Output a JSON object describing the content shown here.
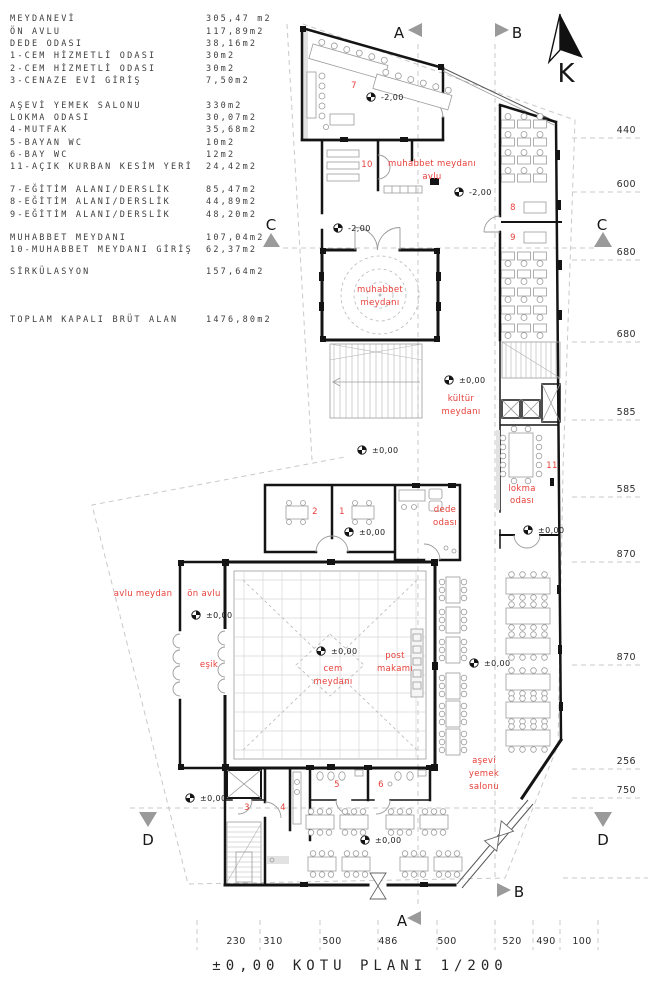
{
  "legend": {
    "rows": [
      {
        "label": "MEYDANEVİ",
        "value": "305,47 m2"
      },
      {
        "label": "ÖN AVLU",
        "value": "117,89m2"
      },
      {
        "label": "DEDE ODASI",
        "value": "38,16m2"
      },
      {
        "label": "1-CEM HİZMETLİ ODASI",
        "value": "30m2"
      },
      {
        "label": "2-CEM HİZMETLİ ODASI",
        "value": "30m2"
      },
      {
        "label": "3-CENAZE EVİ GİRİŞ",
        "value": "7,50m2"
      },
      {
        "label": "AŞEVİ YEMEK SALONU",
        "value": "330m2"
      },
      {
        "label": "LOKMA ODASI",
        "value": "30,07m2"
      },
      {
        "label": "4-MUTFAK",
        "value": "35,68m2"
      },
      {
        "label": "5-BAYAN WC",
        "value": "10m2"
      },
      {
        "label": "6-BAY WC",
        "value": "12m2"
      },
      {
        "label": "11-AÇIK KURBAN KESİM YERİ",
        "value": "24,42m2"
      },
      {
        "label": "7-EĞİTİM ALANI/DERSLİK",
        "value": "85,47m2"
      },
      {
        "label": "8-EĞİTİM ALANI/DERSLİK",
        "value": "44,89m2"
      },
      {
        "label": "9-EĞİTİM ALANI/DERSLİK",
        "value": "48,20m2"
      },
      {
        "label": "MUHABBET MEYDANI",
        "value": "107,04m2"
      },
      {
        "label": "10-MUHABBET MEYDANI GİRİŞ",
        "value": "62,37m2"
      },
      {
        "label": "SİRKÜLASYON",
        "value": "157,64m2"
      },
      {
        "label": "TOPLAM KAPALI BRÜT ALAN",
        "value": "1476,80m2"
      }
    ]
  },
  "plan_title": "±0,00 KOTU PLANI 1/200",
  "north_label": "K",
  "section_markers": {
    "a": "A",
    "b": "B",
    "c": "C",
    "d": "D"
  },
  "dims_right": [
    "440",
    "600",
    "680",
    "680",
    "585",
    "585",
    "870",
    "870",
    "256",
    "750"
  ],
  "dims_bottom": [
    "230",
    "310",
    "500",
    "486",
    "500",
    "520",
    "490",
    "100"
  ],
  "plan": {
    "room_numbers": {
      "r1": "1",
      "r2": "2",
      "r3": "3",
      "r4": "4",
      "r5": "5",
      "r6": "6",
      "r7": "7",
      "r8": "8",
      "r9": "9",
      "r10": "10",
      "r11": "11"
    },
    "labels": {
      "muhabbet_avlu_l1": "muhabbet meydanı",
      "muhabbet_avlu_l2": "avlu",
      "muhabbet_l1": "muhabbet",
      "muhabbet_l2": "meydanı",
      "kultur_l1": "kültür",
      "kultur_l2": "meydanı",
      "lokma_l1": "lokma",
      "lokma_l2": "odası",
      "dede_l1": "dede",
      "dede_l2": "odası",
      "on_avlu": "ön avlu",
      "avlu_meydan": "avlu meydan",
      "esik": "eşik",
      "cem_l1": "cem",
      "cem_l2": "meydanı",
      "post_l1": "post",
      "post_l2": "makamı",
      "asevi_l1": "aşevi",
      "asevi_l2": "yemek",
      "asevi_l3": "salonu"
    },
    "elevations": {
      "zero": "±0,00",
      "minus_two": "-2,00"
    }
  },
  "colors": {
    "red_label": "#e8403a",
    "wall": "#141414",
    "gray_marker": "#9a9a9a",
    "dashed": "#c9c9c9"
  }
}
